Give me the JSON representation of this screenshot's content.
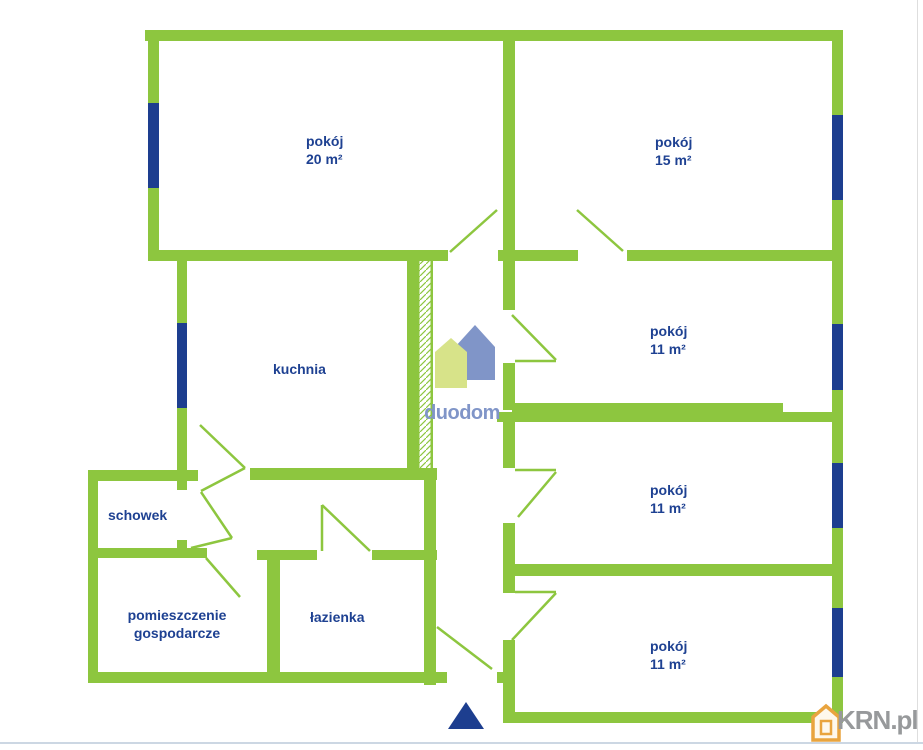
{
  "plan_title": "floor-plan",
  "colors": {
    "wall_green": "#8dc63f",
    "window_navy": "#1d3e8f",
    "label_navy": "#1e4192",
    "duodom_blue": "#8095c8",
    "duodom_light_green": "#d7e389",
    "krn_gray": "#97999b",
    "krn_orange": "#e9a43e"
  },
  "rooms": [
    {
      "name": "pokój",
      "area": "20 m²"
    },
    {
      "name": "pokój",
      "area": "15 m²"
    },
    {
      "name": "pokój",
      "area": "11 m²"
    },
    {
      "name": "pokój",
      "area": "11 m²"
    },
    {
      "name": "pokój",
      "area": "11 m²"
    },
    {
      "name": "kuchnia"
    },
    {
      "name": "schowek"
    },
    {
      "name": "pomieszczenie",
      "name2": "gospodarcze"
    },
    {
      "name": "łazienka"
    }
  ],
  "watermarks": {
    "duodom": "duodom",
    "krn": "KRN.pl"
  },
  "icons": {
    "duodom_logo": "two-houses-logo",
    "krn_house": "house-icon",
    "entrance": "entrance-triangle-arrow"
  }
}
